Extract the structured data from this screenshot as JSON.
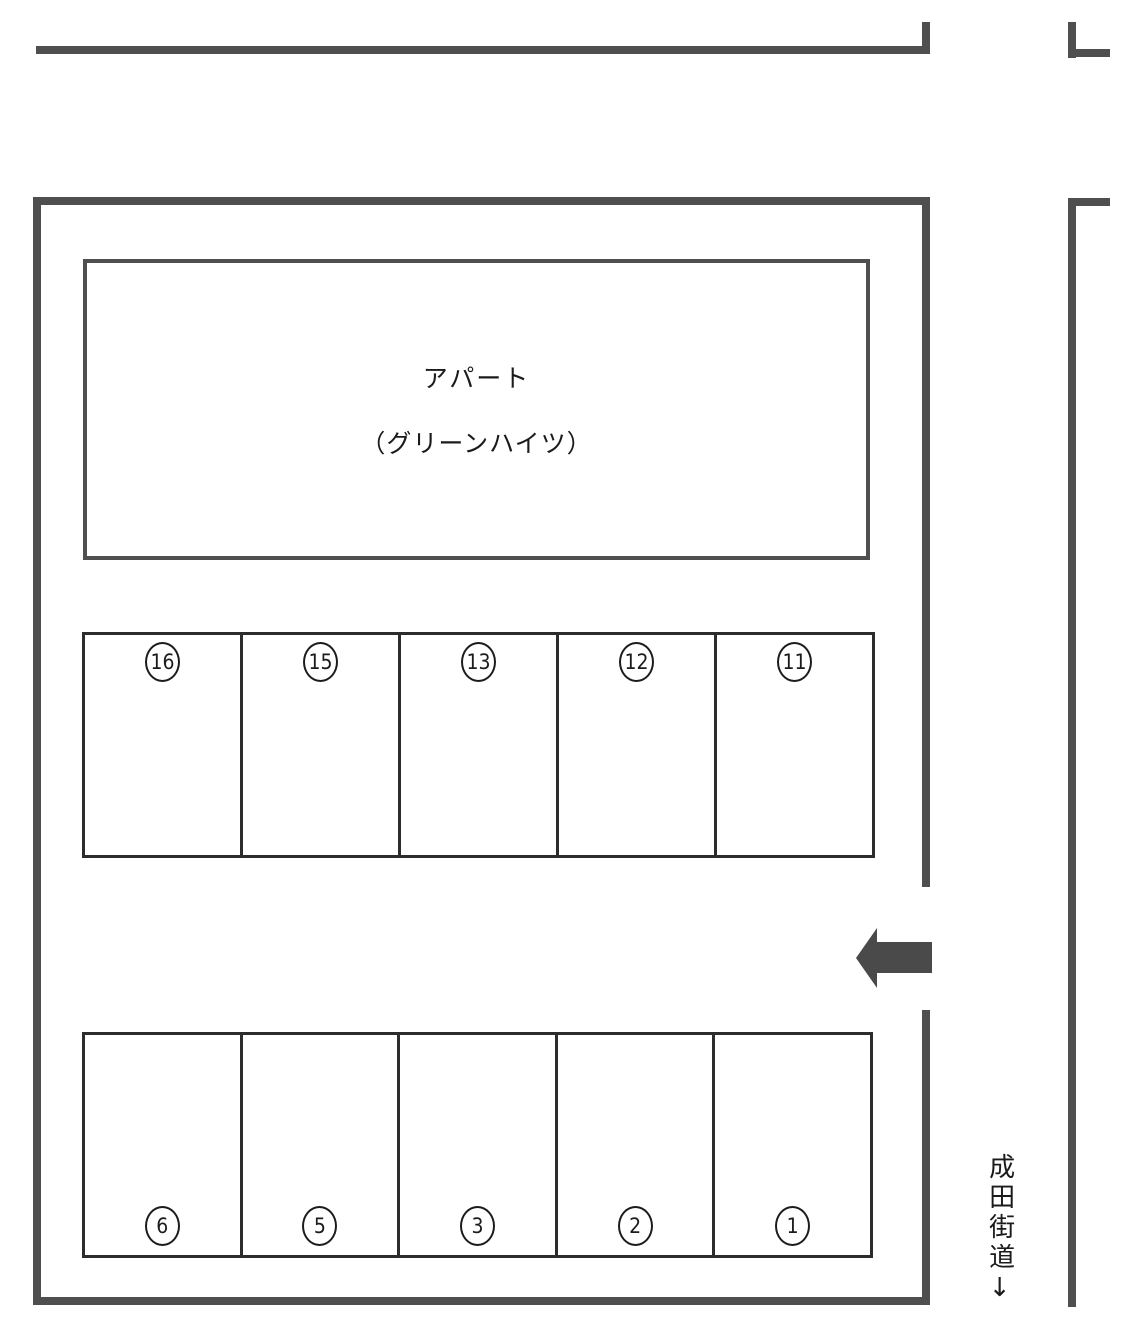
{
  "building": {
    "name_line1": "アパート",
    "name_line2": "（グリーンハイツ）"
  },
  "parking": {
    "upper_row": {
      "spaces": [
        {
          "label": "16"
        },
        {
          "label": "15"
        },
        {
          "label": "13"
        },
        {
          "label": "12"
        },
        {
          "label": "11"
        }
      ]
    },
    "lower_row": {
      "spaces": [
        {
          "label": "6"
        },
        {
          "label": "5"
        },
        {
          "label": "3"
        },
        {
          "label": "2"
        },
        {
          "label": "1"
        }
      ]
    }
  },
  "road": {
    "label_vertical": "成田街道↓",
    "name": "成田街道"
  },
  "icons": {
    "entrance_arrow": "left-arrow",
    "road_direction": "down-arrow"
  },
  "colors": {
    "line": "#4f4f4f",
    "stall_border": "#2c2c2c",
    "arrow": "#4a4a4a",
    "text": "#1b1b1b",
    "background": "#ffffff"
  }
}
